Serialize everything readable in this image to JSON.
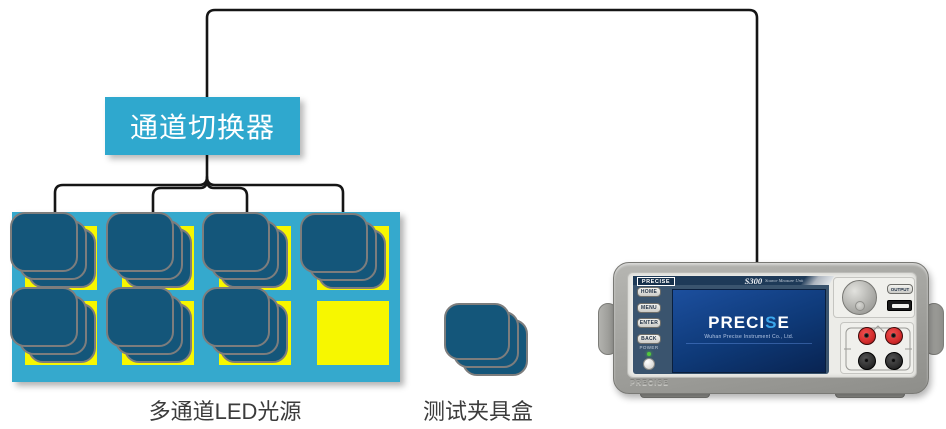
{
  "diagram": {
    "channel_switcher_label": "通道切换器",
    "led_source_label": "多通道LED光源",
    "fixture_label": "测试夹具盒"
  },
  "instrument": {
    "brand": "PRECISE",
    "model": "S300",
    "model_subtitle": "Source Measure Unit",
    "buttons": [
      "HOME",
      "MENU",
      "ENTER",
      "BACK"
    ],
    "power_label": "POWER",
    "output_button": "OUTPUT",
    "screen": {
      "logo_pre": "PRECI",
      "logo_s": "S",
      "logo_post": "E",
      "subtitle": "Wuhan Precise Instrument Co., Ltd."
    },
    "chassis_brand": "PRECISE"
  },
  "colors": {
    "cyan": "#2FA8CE",
    "board_cyan": "#35A9CD",
    "socket_yellow": "#F7F700",
    "module_blue": "#14567A",
    "module_border": "#7D7D7D",
    "wire_black": "#151515",
    "screen_blue": "#0E3977",
    "logo_accent_blue": "#3BA7EC",
    "chassis_gray": "#A3A39F",
    "led_green": "#52C93C",
    "jack_red": "#D22B2B"
  }
}
